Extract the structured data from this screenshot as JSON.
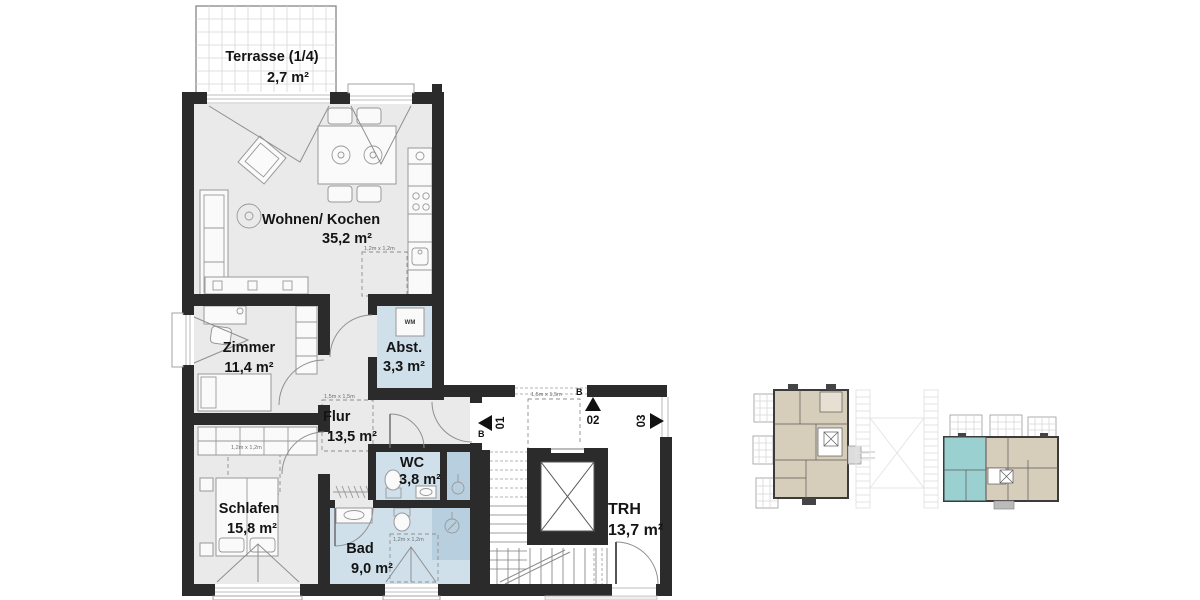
{
  "rooms": {
    "terrasse": {
      "name": "Terrasse (1/4)",
      "area": "2,7 m²"
    },
    "wohnen": {
      "name": "Wohnen/ Kochen",
      "area": "35,2 m²"
    },
    "zimmer": {
      "name": "Zimmer",
      "area": "11,4 m²"
    },
    "abstellraum": {
      "name": "Abst.",
      "area": "3,3 m²"
    },
    "flur": {
      "name": "Flur",
      "area": "13,5 m²"
    },
    "wc": {
      "name": "WC",
      "area": "3,8 m²"
    },
    "schlafen": {
      "name": "Schlafen",
      "area": "15,8 m²"
    },
    "bad": {
      "name": "Bad",
      "area": "9,0 m²"
    },
    "trh": {
      "name": "TRH",
      "area": "13,7 m²"
    }
  },
  "markers": {
    "unit_01": "01",
    "unit_02": "02",
    "unit_03": "03",
    "section_b": "B"
  },
  "dimensions": {
    "square_12": "1,2m x 1,2m",
    "square_15": "1,5m x 1,5m"
  },
  "appliances": {
    "washing_machine": "WM"
  },
  "colors": {
    "wall": "#2b2b2b",
    "floor": "#eaeaea",
    "wet_room": "#cfe0eb",
    "shower": "#b7cfdf",
    "mini_unit_beige": "#d7cdbb",
    "mini_unit_highlight": "#9bd0d1"
  }
}
